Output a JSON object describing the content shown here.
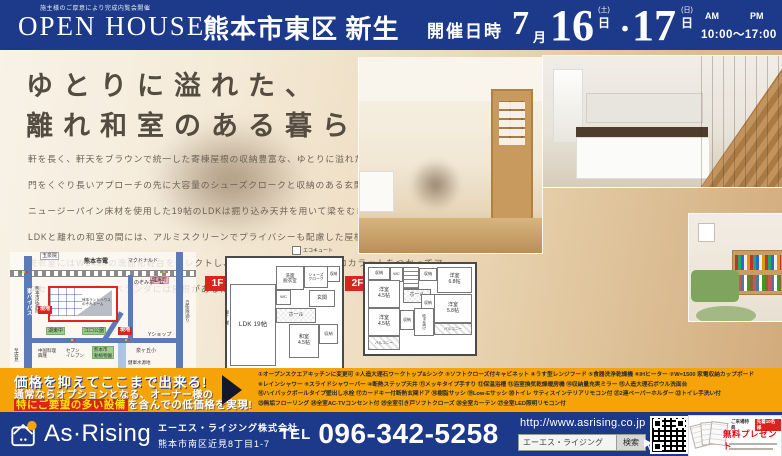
{
  "header": {
    "notice": "施主様のご厚意により完成内覧会開催",
    "open_house": "OPEN HOUSE",
    "location": "熊本市東区 新生",
    "event_label": "開催日時",
    "month": "7",
    "month_unit": "月",
    "day1": "16",
    "day1_dow": "(土)",
    "day1_unit": "日",
    "separator": "・",
    "day2": "17",
    "day2_dow": "(日)",
    "day2_unit": "日",
    "am": "AM",
    "pm": "PM",
    "time": "10:00〜17:00"
  },
  "hero": {
    "title1": "ゆとりに溢れた、",
    "title2": "離れ和室のある暮らし",
    "body": [
      "軒を長く、軒天をブラウンで統一した寄棟屋根の収納豊富な、ゆとりに溢れた5LDKの住まい。",
      "門をくぐり長いアプローチの先に大容量のシューズクロークと収納のある玄関。",
      "ニュージーパイン床材を使用した19帖のLDKは掘り込み天井を用いて梁をむき出しに。",
      "LDKと離れの和室の間には、アルミスクリーンでプライバシーも配慮した屋根つきの中庭。洗面",
      "脱衣室にはW1450の洗面化粧台をセレクトし、壁には調湿作用のあるエコカラットをつかってア",
      "クセントに。二階のベランダには屋根があるため急な雨にも安心です。"
    ]
  },
  "map": {
    "tram": "熊本市電",
    "temple": "玉泉院",
    "mcdonalds": "マクドナルド",
    "kengun_sta": "健軍町",
    "bypass": "東バイパス",
    "hospital": "熊本市民病院",
    "site": "現地",
    "estate_note": "熊本ランドハウス\nのぞみホーム",
    "nozomi_home": "のぞみホーム",
    "kotou_jhs": "湖東中",
    "eguchi_park": "江口公園",
    "y_shop": "Yショップ",
    "chinese_rest": "中国料理\n興隆",
    "seven_eleven": "セブン\nイレブン",
    "zoo": "熊本市\n動植物園",
    "izumigaoka_es": "泉ヶ丘小",
    "water_source": "健軍水源地",
    "to_chikami": "至近見",
    "jieitai_st": "自衛隊通り"
  },
  "floorplans": {
    "f1": {
      "label": "1F",
      "ldk": "LDK 19帖",
      "washitsu": "和室\n4.5帖",
      "hall": "ホール",
      "genkan": "玄関",
      "shoes": "シューズ\nクローク",
      "closet": "収納",
      "sanitary": "洗面\n脱衣室",
      "wc": "WC",
      "ecocute": "エコキュート",
      "monohoshi": "物干し場"
    },
    "f2": {
      "label": "2F",
      "room_a": "洋室\n4.5帖",
      "room_b": "洋室\n4.5帖",
      "room_c": "洋室\n6.8帖",
      "room_d": "洋室\n5.8帖",
      "hall": "ホール",
      "closet": "収納",
      "void": "吹き抜け",
      "balcony": "バルコニー",
      "wc": "WC"
    }
  },
  "promo": {
    "line1": "価格を抑えてここまで出来る!",
    "line2": "通常ならオプションとなる、オーナー様の",
    "line3_highlight": "特にご要望の多い設備",
    "line3_rest": "を含んでの低価格を実現!"
  },
  "features": {
    "lines": [
      "①オープンスクエアキッチンに変更可 ②人造大理石ワークトップ&シンク ③ソフトクローズ付キャビネット ④うす型レンジフード ⑤食器洗浄乾燥機 ⑥IHヒーター ⑦W=1500 家電収納カップボード",
      "⑧レインシャワー ⑨スライドシャワーバー ⑩断熱ステップ天井 ⑪メッキタイプ手すり ⑫保温浴槽 ⑬浴室換気乾燥暖房機 ⑭収納量充実ミラー ⑮人造大理石ボウル洗面台",
      "⑯ハイバックボールタイプ壁出し水栓 ⑰カードキー付断熱玄関ドア ⑱樹脂サッシ ⑲Low-Eサッシ ⑳トイレ サティスインテリアリモコン付 ㉑2連ペーパーホルダー ㉒トイレ手洗い付",
      "㉓無垢フローリング ㉔全室AC-TVコンセント付 ㉕全室引き戸ソフトクローズ ㉖全室カーテン ㉗全室LED照明リモコン付"
    ]
  },
  "footer": {
    "logo_text": "As·Rising",
    "company": "エーエス・ライジング株式会社",
    "address": "熊本市南区近見8丁目1-7",
    "tel_label": "TEL",
    "tel_number": "096-342-5258",
    "url": "http://www.asrising.co.jp",
    "search_query": "エーエス・ライジング",
    "search_button": "検索",
    "visitor_bonus": "ご来場特典",
    "bonus_badge": "先着10名様",
    "bonus_title": "無料プレゼント"
  },
  "colors": {
    "navy": "#1d3a8a",
    "orange": "#f5a306",
    "red": "#d9251d",
    "highlight_yellow": "#ffe600"
  }
}
